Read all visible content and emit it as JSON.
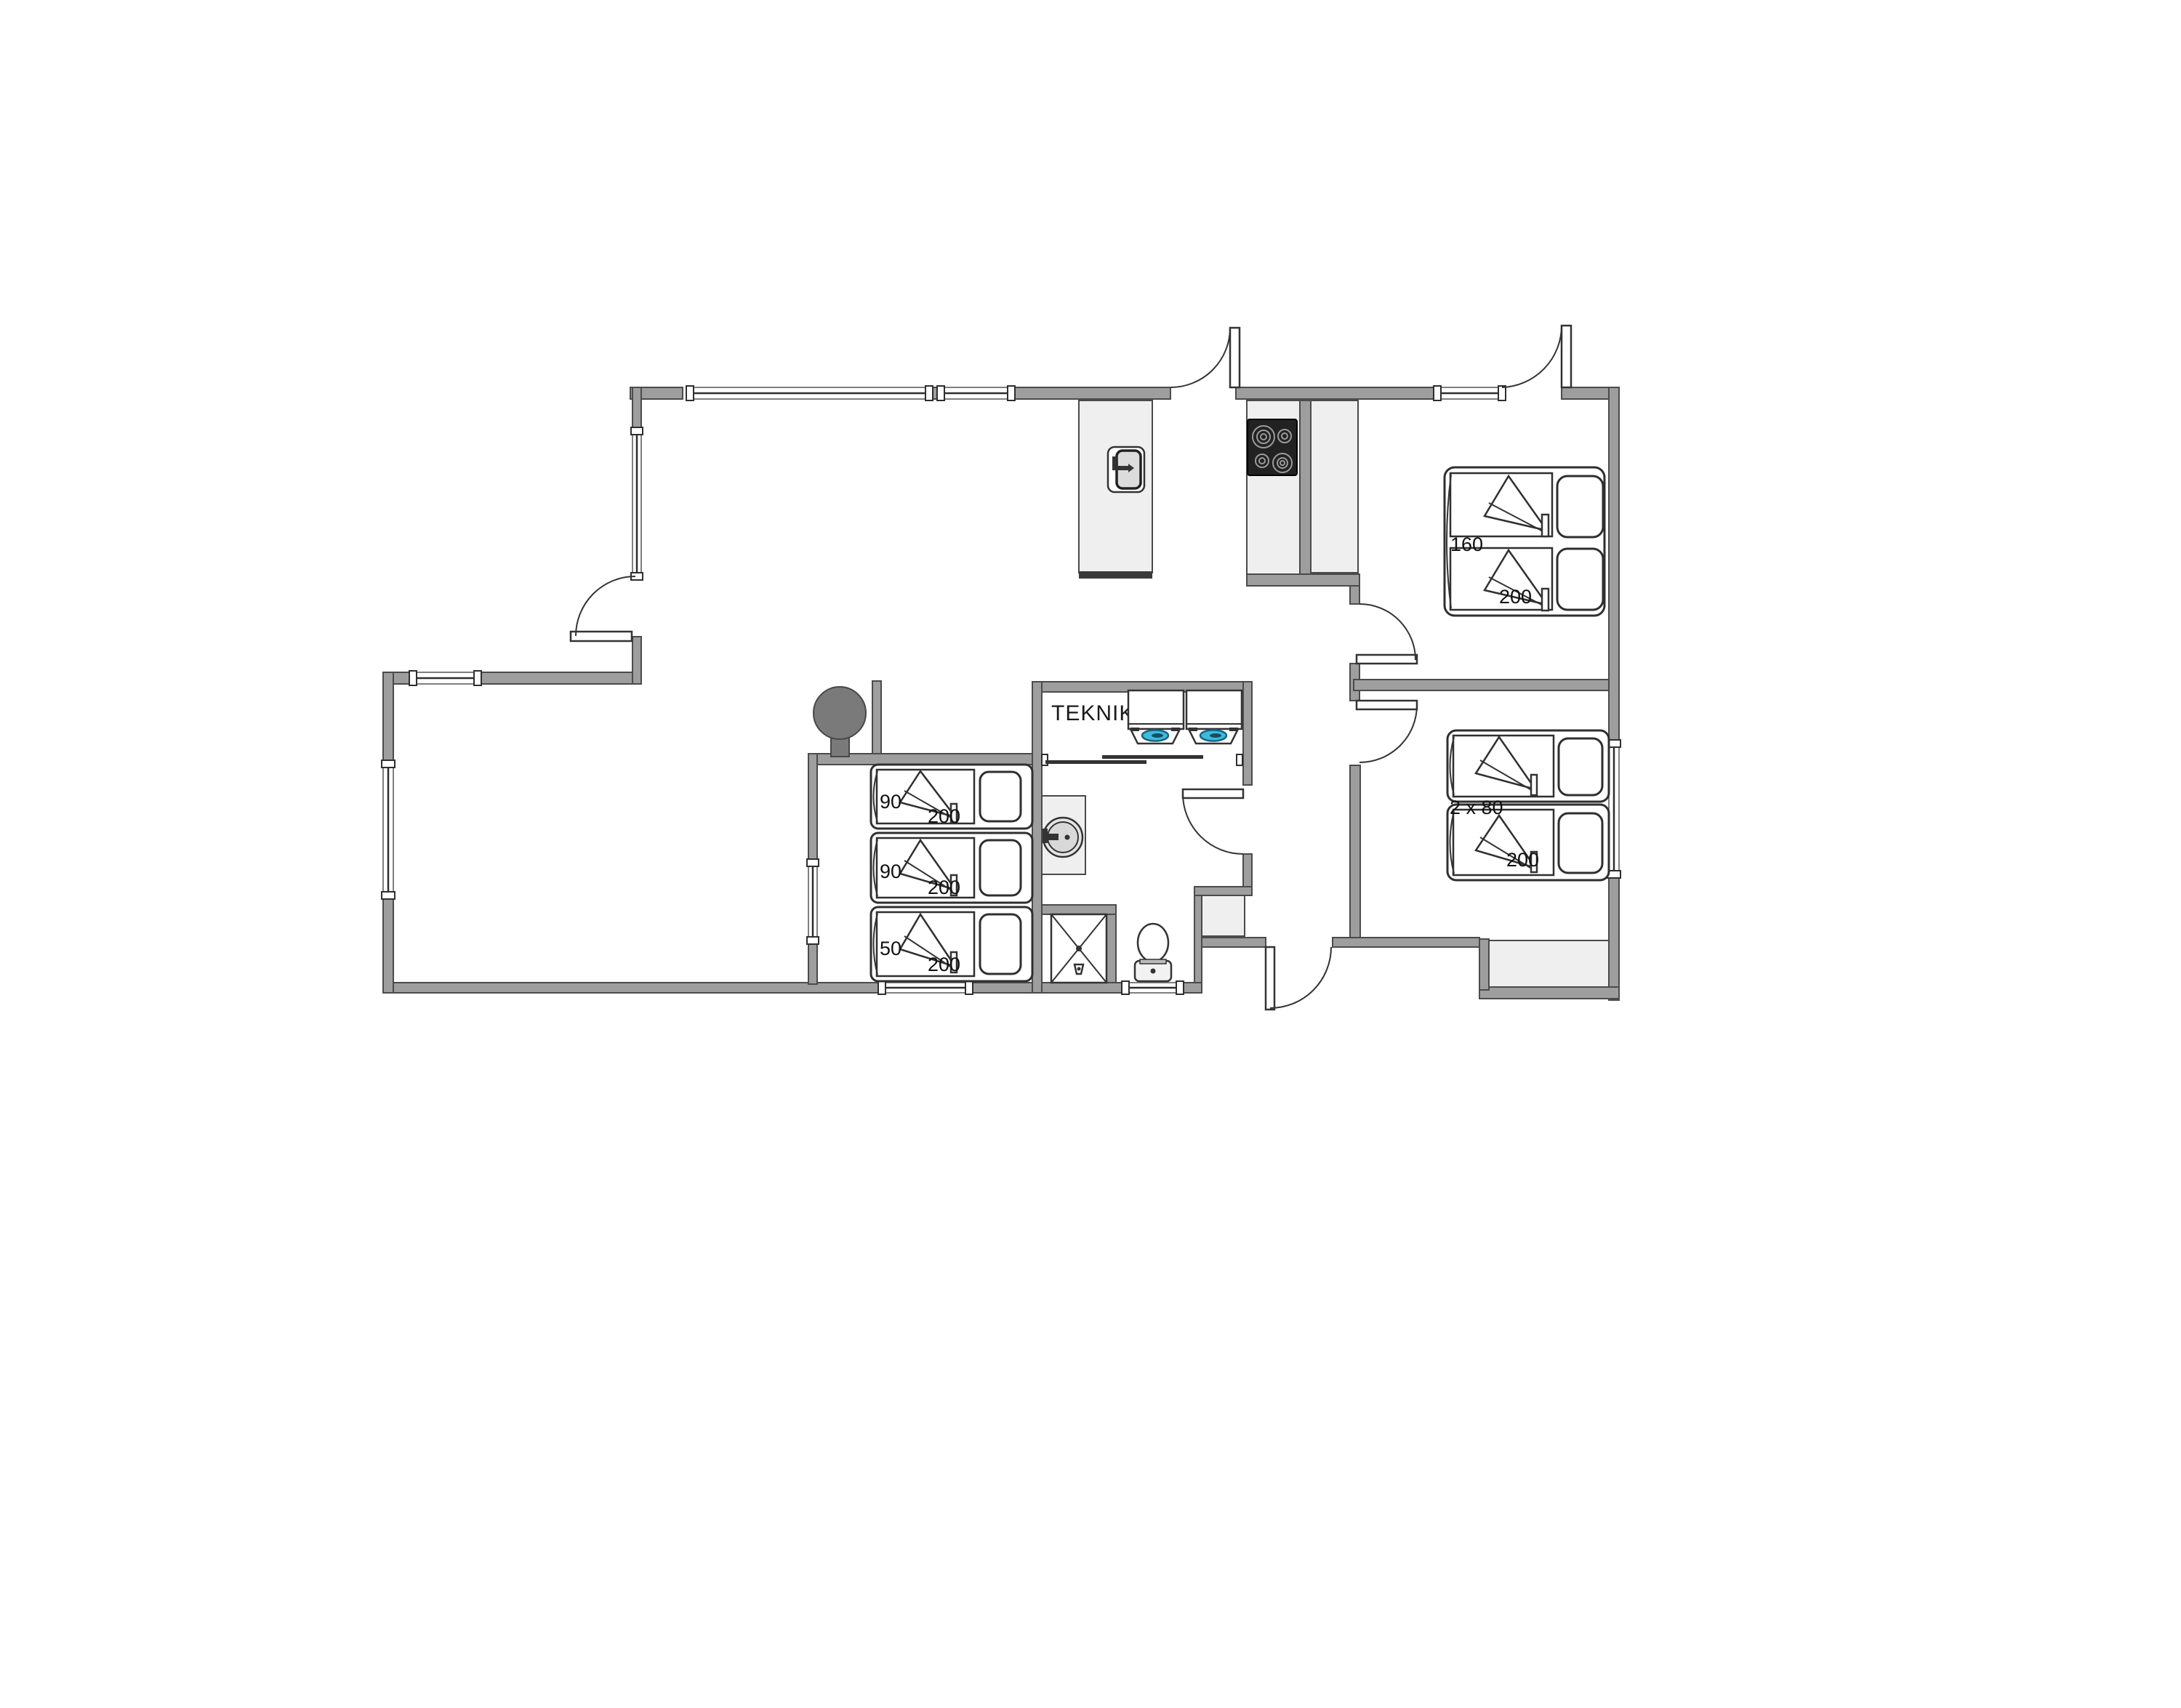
{
  "floorplan": {
    "labels": {
      "utility_room": "TEKNIK",
      "double_bed": {
        "width": "160",
        "length": "200"
      },
      "twin_beds": {
        "width": "2 x 80",
        "length": "200"
      },
      "bunk_top": {
        "width": "90",
        "length": "200"
      },
      "bunk_middle": {
        "width": "90",
        "length": "200"
      },
      "bunk_bottom": {
        "width": "50",
        "length": "200"
      }
    },
    "colors": {
      "wall": "#9e9e9e",
      "wall_outline": "#4b4b4b",
      "furniture": "#efefef",
      "stove": "#7a7a7a",
      "cooktop": "#222222",
      "washer_glass": "#3fb9de",
      "background": "#ffffff"
    }
  }
}
